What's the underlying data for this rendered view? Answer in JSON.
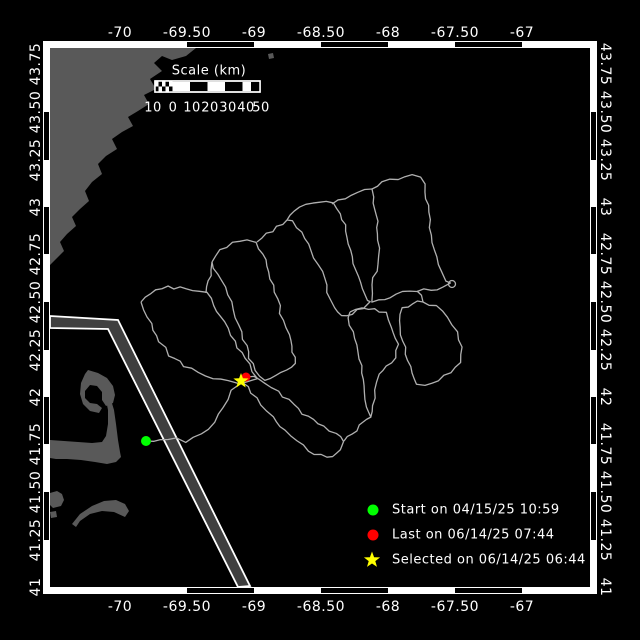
{
  "axes": {
    "top": [
      "-70",
      "-69.50",
      "-69",
      "-68.50",
      "-68",
      "-67.50",
      "-67"
    ],
    "bottom": [
      "-70",
      "-69.50",
      "-69",
      "-68.50",
      "-68",
      "-67.50",
      "-67"
    ],
    "left": [
      "43.75",
      "43.50",
      "43.25",
      "43",
      "42.75",
      "42.50",
      "42.25",
      "42",
      "41.75",
      "41.50",
      "41.25",
      "41"
    ],
    "right": [
      "43.75",
      "43.50",
      "43.25",
      "43",
      "42.75",
      "42.50",
      "42.25",
      "42",
      "41.75",
      "41.50",
      "41.25",
      "41"
    ]
  },
  "scale_bar": {
    "title": "Scale (km)",
    "labels": [
      "10",
      "0",
      "10",
      "20",
      "30",
      "40",
      "50"
    ]
  },
  "legend": {
    "items": [
      {
        "marker": "start-dot",
        "color": "#00ff00",
        "label": "Start on 04/15/25 10:59"
      },
      {
        "marker": "last-dot",
        "color": "#ff0000",
        "label": "Last on 06/14/25 07:44"
      },
      {
        "marker": "selected-star",
        "color": "#ffff00",
        "label": "Selected on 06/14/25 06:44"
      }
    ]
  },
  "colors": {
    "background": "#000000",
    "frame": "#ffffff",
    "land": "#595959",
    "lane_fill": "#3f3f3f",
    "track": "#b0b0b0",
    "text": "#ffffff",
    "start": "#00ff00",
    "last": "#ff0000",
    "selected": "#ffff00"
  },
  "map_data": {
    "type": "map-track",
    "markers": {
      "start": {
        "x": 146,
        "y": 441
      },
      "last": {
        "x": 246,
        "y": 377
      },
      "selected": {
        "x": 241,
        "y": 381
      },
      "knot": {
        "x": 452,
        "y": 284,
        "r": 3.5
      }
    },
    "land": [
      [
        [
          50,
          48
        ],
        [
          196,
          48
        ],
        [
          186,
          56
        ],
        [
          172,
          60
        ],
        [
          162,
          56
        ],
        [
          154,
          63
        ],
        [
          162,
          71
        ],
        [
          150,
          79
        ],
        [
          156,
          89
        ],
        [
          144,
          95
        ],
        [
          149,
          104
        ],
        [
          138,
          111
        ],
        [
          128,
          117
        ],
        [
          133,
          126
        ],
        [
          122,
          132
        ],
        [
          112,
          139
        ],
        [
          117,
          149
        ],
        [
          106,
          156
        ],
        [
          98,
          164
        ],
        [
          102,
          174
        ],
        [
          92,
          182
        ],
        [
          85,
          191
        ],
        [
          89,
          201
        ],
        [
          80,
          209
        ],
        [
          72,
          217
        ],
        [
          76,
          226
        ],
        [
          67,
          234
        ],
        [
          60,
          242
        ],
        [
          64,
          251
        ],
        [
          56,
          259
        ],
        [
          50,
          265
        ]
      ],
      [
        [
          268,
          54
        ],
        [
          273,
          53
        ],
        [
          274,
          58
        ],
        [
          269,
          59
        ]
      ],
      [
        [
          50,
          440
        ],
        [
          64,
          441
        ],
        [
          78,
          442
        ],
        [
          92,
          443
        ],
        [
          102,
          442
        ],
        [
          106,
          436
        ],
        [
          108,
          424
        ],
        [
          108,
          410
        ],
        [
          106,
          400
        ],
        [
          111,
          400
        ],
        [
          114,
          410
        ],
        [
          116,
          424
        ],
        [
          118,
          440
        ],
        [
          120,
          452
        ],
        [
          121,
          457
        ],
        [
          116,
          462
        ],
        [
          107,
          464
        ],
        [
          95,
          462
        ],
        [
          81,
          460
        ],
        [
          67,
          459
        ],
        [
          56,
          459
        ],
        [
          50,
          458
        ]
      ],
      [
        [
          88,
          370
        ],
        [
          98,
          373
        ],
        [
          107,
          378
        ],
        [
          113,
          386
        ],
        [
          115,
          395
        ],
        [
          113,
          403
        ],
        [
          106,
          406
        ],
        [
          102,
          400
        ],
        [
          102,
          392
        ],
        [
          97,
          386
        ],
        [
          90,
          385
        ],
        [
          85,
          391
        ],
        [
          85,
          398
        ],
        [
          90,
          403
        ],
        [
          97,
          404
        ],
        [
          102,
          408
        ],
        [
          99,
          413
        ],
        [
          90,
          411
        ],
        [
          83,
          404
        ],
        [
          80,
          394
        ],
        [
          81,
          383
        ],
        [
          85,
          374
        ]
      ],
      [
        [
          72,
          524
        ],
        [
          80,
          514
        ],
        [
          92,
          506
        ],
        [
          104,
          501
        ],
        [
          116,
          500
        ],
        [
          125,
          504
        ],
        [
          129,
          511
        ],
        [
          125,
          517
        ],
        [
          114,
          512
        ],
        [
          102,
          511
        ],
        [
          90,
          514
        ],
        [
          80,
          521
        ],
        [
          76,
          527
        ]
      ],
      [
        [
          50,
          493
        ],
        [
          57,
          491
        ],
        [
          62,
          494
        ],
        [
          64,
          500
        ],
        [
          61,
          506
        ],
        [
          53,
          508
        ],
        [
          50,
          505
        ]
      ],
      [
        [
          50,
          512
        ],
        [
          56,
          511
        ],
        [
          57,
          517
        ],
        [
          51,
          518
        ]
      ]
    ],
    "lane": [
      [
        50,
        316
      ],
      [
        118,
        320
      ],
      [
        250,
        586
      ],
      [
        238,
        587
      ],
      [
        108,
        329
      ],
      [
        50,
        328
      ]
    ],
    "track": {
      "rings": [
        [
          [
            141,
            302
          ],
          [
            150,
            293
          ],
          [
            168,
            287
          ],
          [
            186,
            289
          ],
          [
            206,
            293
          ],
          [
            215,
            305
          ],
          [
            224,
            322
          ],
          [
            234,
            342
          ],
          [
            244,
            359
          ],
          [
            253,
            371
          ],
          [
            257,
            378
          ],
          [
            249,
            383
          ],
          [
            240,
            384
          ],
          [
            228,
            382
          ],
          [
            213,
            379
          ],
          [
            198,
            373
          ],
          [
            184,
            366
          ],
          [
            170,
            355
          ],
          [
            160,
            341
          ],
          [
            151,
            324
          ],
          [
            143,
            310
          ],
          [
            141,
            302
          ]
        ],
        [
          [
            212,
            262
          ],
          [
            220,
            250
          ],
          [
            233,
            244
          ],
          [
            247,
            240
          ],
          [
            257,
            242
          ],
          [
            263,
            254
          ],
          [
            269,
            272
          ],
          [
            275,
            292
          ],
          [
            281,
            313
          ],
          [
            288,
            335
          ],
          [
            293,
            352
          ],
          [
            295,
            363
          ],
          [
            287,
            371
          ],
          [
            276,
            376
          ],
          [
            265,
            380
          ],
          [
            258,
            377
          ],
          [
            252,
            364
          ],
          [
            246,
            346
          ],
          [
            239,
            325
          ],
          [
            231,
            302
          ],
          [
            222,
            280
          ],
          [
            214,
            268
          ],
          [
            212,
            262
          ]
        ],
        [
          [
            287,
            220
          ],
          [
            294,
            211
          ],
          [
            306,
            205
          ],
          [
            320,
            202
          ],
          [
            332,
            204
          ],
          [
            340,
            214
          ],
          [
            346,
            231
          ],
          [
            351,
            250
          ],
          [
            356,
            270
          ],
          [
            362,
            289
          ],
          [
            368,
            300
          ],
          [
            371,
            303
          ],
          [
            363,
            308
          ],
          [
            352,
            313
          ],
          [
            341,
            316
          ],
          [
            334,
            308
          ],
          [
            328,
            292
          ],
          [
            321,
            272
          ],
          [
            312,
            250
          ],
          [
            302,
            232
          ],
          [
            292,
            222
          ],
          [
            287,
            220
          ]
        ],
        [
          [
            372,
            189
          ],
          [
            382,
            182
          ],
          [
            398,
            178
          ],
          [
            412,
            176
          ],
          [
            421,
            177
          ],
          [
            426,
            192
          ],
          [
            429,
            212
          ],
          [
            432,
            235
          ],
          [
            436,
            257
          ],
          [
            441,
            272
          ],
          [
            447,
            280
          ],
          [
            451,
            284
          ],
          [
            443,
            288
          ],
          [
            431,
            289
          ],
          [
            417,
            291
          ],
          [
            403,
            293
          ],
          [
            390,
            297
          ],
          [
            379,
            300
          ],
          [
            371,
            302
          ],
          [
            373,
            285
          ],
          [
            377,
            264
          ],
          [
            379,
            240
          ],
          [
            377,
            215
          ],
          [
            372,
            197
          ],
          [
            372,
            189
          ]
        ],
        [
          [
            423,
            302
          ],
          [
            436,
            306
          ],
          [
            448,
            317
          ],
          [
            457,
            332
          ],
          [
            462,
            347
          ],
          [
            460,
            362
          ],
          [
            451,
            373
          ],
          [
            438,
            380
          ],
          [
            425,
            384
          ],
          [
            417,
            384
          ],
          [
            412,
            373
          ],
          [
            406,
            354
          ],
          [
            400,
            335
          ],
          [
            398,
            320
          ],
          [
            403,
            309
          ],
          [
            412,
            303
          ],
          [
            423,
            302
          ]
        ],
        [
          [
            350,
            312
          ],
          [
            362,
            308
          ],
          [
            375,
            308
          ],
          [
            385,
            313
          ],
          [
            392,
            327
          ],
          [
            397,
            344
          ],
          [
            395,
            357
          ],
          [
            386,
            366
          ],
          [
            379,
            374
          ],
          [
            375,
            390
          ],
          [
            374,
            406
          ],
          [
            371,
            417
          ],
          [
            367,
            407
          ],
          [
            365,
            392
          ],
          [
            362,
            373
          ],
          [
            357,
            352
          ],
          [
            352,
            332
          ],
          [
            349,
            318
          ],
          [
            350,
            312
          ]
        ]
      ],
      "connectors": [
        [
          [
            146,
            441
          ],
          [
            154,
            442
          ],
          [
            161,
            438
          ],
          [
            169,
            441
          ],
          [
            177,
            437
          ],
          [
            185,
            441
          ],
          [
            193,
            437
          ],
          [
            201,
            433
          ],
          [
            208,
            429
          ],
          [
            214,
            422
          ],
          [
            218,
            414
          ],
          [
            222,
            407
          ],
          [
            227,
            399
          ],
          [
            232,
            391
          ],
          [
            237,
            385
          ],
          [
            241,
            381
          ]
        ],
        [
          [
            243,
            383
          ],
          [
            252,
            392
          ],
          [
            262,
            404
          ],
          [
            273,
            417
          ],
          [
            285,
            430
          ],
          [
            297,
            441
          ],
          [
            309,
            450
          ],
          [
            321,
            456
          ],
          [
            333,
            457
          ],
          [
            341,
            450
          ],
          [
            344,
            441
          ],
          [
            336,
            434
          ],
          [
            323,
            427
          ],
          [
            308,
            417
          ],
          [
            293,
            405
          ],
          [
            278,
            392
          ],
          [
            265,
            382
          ],
          [
            254,
            376
          ],
          [
            246,
            377
          ]
        ],
        [
          [
            206,
            293
          ],
          [
            209,
            281
          ],
          [
            211,
            270
          ],
          [
            212,
            262
          ]
        ],
        [
          [
            257,
            242
          ],
          [
            267,
            234
          ],
          [
            277,
            227
          ],
          [
            287,
            220
          ]
        ],
        [
          [
            332,
            204
          ],
          [
            345,
            198
          ],
          [
            358,
            193
          ],
          [
            372,
            189
          ]
        ],
        [
          [
            344,
            441
          ],
          [
            352,
            434
          ],
          [
            360,
            426
          ],
          [
            367,
            420
          ],
          [
            371,
            417
          ]
        ],
        [
          [
            417,
            291
          ],
          [
            420,
            296
          ],
          [
            423,
            302
          ]
        ]
      ]
    }
  }
}
